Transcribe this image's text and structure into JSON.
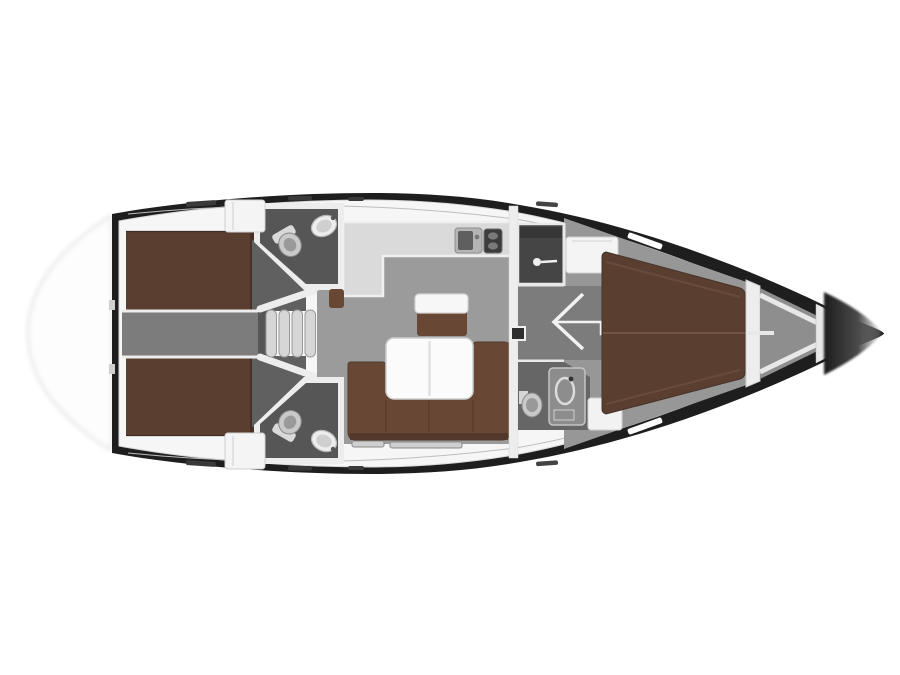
{
  "diagram": {
    "type": "yacht-interior-floor-plan",
    "orientation": "bow-right",
    "rooms": {
      "aft_cabin_port": "aft double cabin (top)",
      "aft_cabin_starboard": "aft double cabin (bottom)",
      "companionway": "companionway steps and corridor",
      "head_aft_port": "aft head with toilet and sink (top)",
      "head_aft_starboard": "aft head with toilet and sink (bottom)",
      "salon": "salon with U-sofa and folding table",
      "galley": "L-galley with sink and two-burner stove",
      "head_forward": "forward head with shower, toilet and sink",
      "cabin_forward": "forward double V-berth cabin",
      "bow_locker": "anchor locker in bow"
    }
  },
  "colors": {
    "background": "#ffffff",
    "hull": "#1e1e1e",
    "deck": "#f6f6f6",
    "wall": "#ededed",
    "floor_salon": "#9b9b9b",
    "floor_cabin": "#979797",
    "floor_corridor": "#7c7c7c",
    "floor_head": "#565656",
    "floor_wc": "#666666",
    "floor_wedge": "#606060",
    "berth": "#5a3f30",
    "berth_dark": "#453126",
    "sofa": "#684734",
    "sofa_dark": "#4f372a",
    "counter": "#dadada",
    "table": "#fbfbfb",
    "fixture": "#ececec",
    "locker": "#8e8e8e",
    "shower": "#454545",
    "step": "#d6d6d6",
    "bow_tip_fade": "#b5b5b5"
  }
}
